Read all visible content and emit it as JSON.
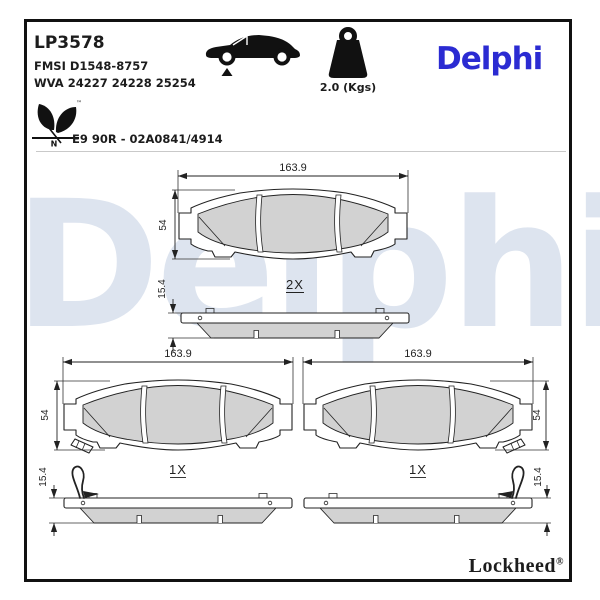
{
  "header": {
    "part_number": "LP3578",
    "fmsi": "FMSI D1548-8757",
    "wva": "WVA 24227 24228 25254",
    "weight_label": "2.0 (Kgs)",
    "brand": "Delphi",
    "approval": "E9 90R - 02A0841/4914",
    "eco_mark_letter": "N",
    "eco_trademark": "™",
    "icons": [
      "car-front-axle-icon",
      "weight-kg-icon",
      "eco-leaf-icon"
    ]
  },
  "watermark": "Delphi",
  "footer": {
    "brand": "Lockheed",
    "registered": "®"
  },
  "drawings": {
    "pad_top": {
      "width_dim": "163.9",
      "height_dim": "54",
      "qty": "2X"
    },
    "profile_top": {
      "thickness_dim": "15.4"
    },
    "pad_left": {
      "width_dim": "163.9",
      "height_dim": "54",
      "qty": "1X"
    },
    "pad_right": {
      "width_dim": "163.9",
      "height_dim": "54",
      "qty": "1X"
    },
    "profile_left": {
      "thickness_dim": "15.4"
    },
    "profile_right": {
      "thickness_dim": "15.4"
    }
  },
  "colors": {
    "brand_blue": "#2b2bd2",
    "watermark_blue": "#dde4ef",
    "friction_gray": "#d2d2d2",
    "line_black": "#1c1c1c"
  }
}
